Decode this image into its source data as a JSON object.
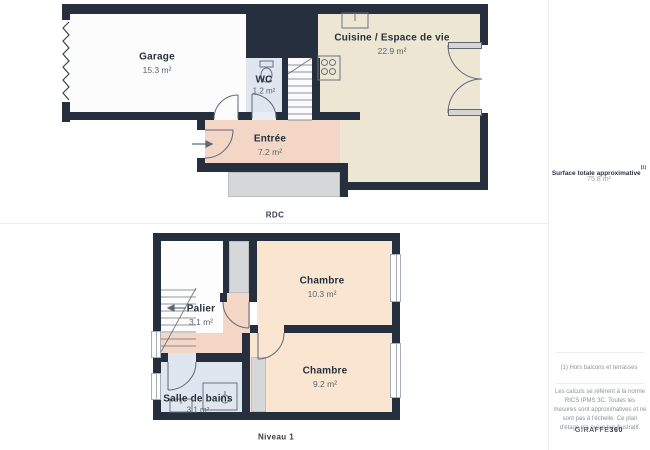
{
  "floors": {
    "rdc": {
      "caption": "RDC",
      "rooms": {
        "garage": {
          "name": "Garage",
          "area": "15.3 m²"
        },
        "wc": {
          "name": "WC",
          "area": "1.2 m²"
        },
        "cuisine": {
          "name": "Cuisine / Espace de vie",
          "area": "22.9 m²"
        },
        "entree": {
          "name": "Entrée",
          "area": "7.2 m²"
        }
      }
    },
    "niveau1": {
      "caption": "Niveau 1",
      "rooms": {
        "palier": {
          "name": "Palier",
          "area": "3.1 m²"
        },
        "chambre_1": {
          "name": "Chambre",
          "area": "10.3 m²"
        },
        "chambre_2": {
          "name": "Chambre",
          "area": "9.2 m²"
        },
        "salle_de_bains": {
          "name": "Salle de bains",
          "area": "3.1 m²"
        }
      }
    }
  },
  "sidebar": {
    "surface_title": "Surface totale approximative",
    "surface_title_sup": "(1)",
    "surface_total": "75.8 m²",
    "footnote": "(1) Hors balcons et terrasses",
    "disclaimer": "Les calculs se réfèrent à la norme RICS IPMS 3C. Toutes les mesures sont approximatives et ne sont pas à l'échelle. Ce plan d'étage n'a qu'un but illustratif.",
    "brand": "GIRAFFE",
    "brand_suffix": "360"
  },
  "colors": {
    "wall": "#252f3e",
    "kitchen_floor": "#ece6d3",
    "hall_floor": "#f3d6c5",
    "bedroom_floor": "#fae5d1",
    "wet_room_floor": "#dfe6ef",
    "closet_gray": "#d6d7d9",
    "room_white": "#fcfcfc"
  }
}
